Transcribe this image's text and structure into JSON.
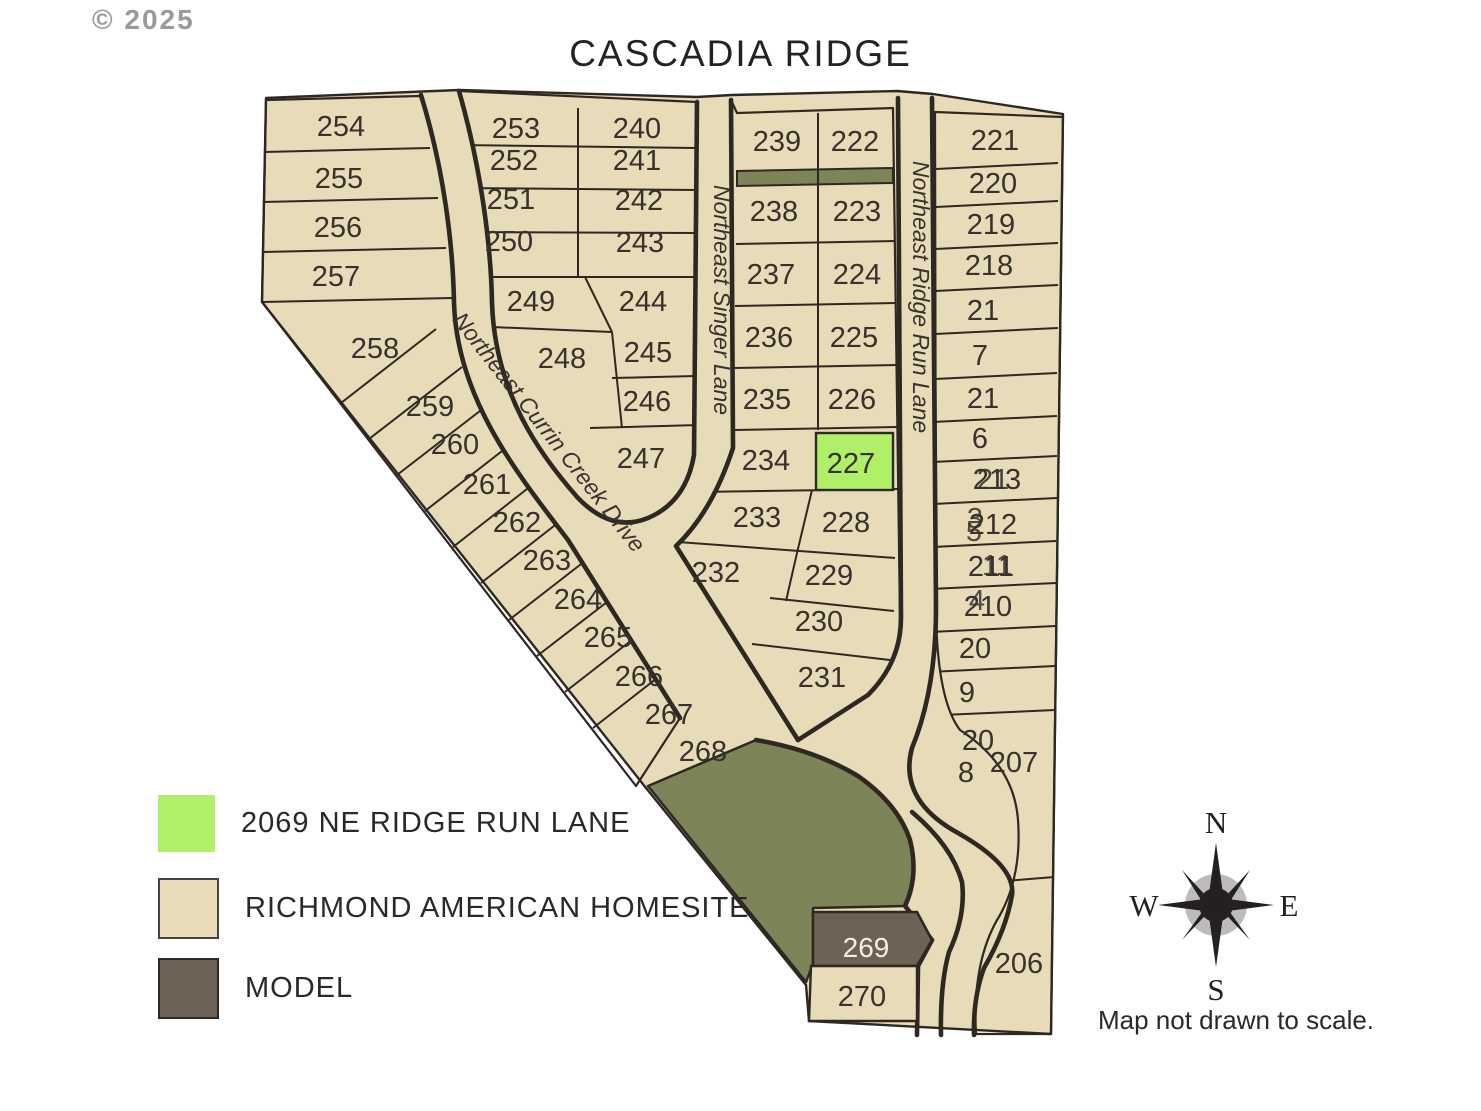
{
  "copyright": "© 2025",
  "title": "CASCADIA RIDGE",
  "footnote": "Map not drawn to scale.",
  "compass": {
    "n": "N",
    "e": "E",
    "s": "S",
    "w": "W"
  },
  "legend": {
    "items": [
      {
        "swatch": "highlight",
        "label": "2069 NE RIDGE RUN LANE"
      },
      {
        "swatch": "homesite",
        "label": "RICHMOND AMERICAN HOMESITE"
      },
      {
        "swatch": "model",
        "label": "MODEL"
      }
    ]
  },
  "colors": {
    "lot_fill": "#e8dbb8",
    "line": "#2e2823",
    "open_space": "#7d8457",
    "highlight": "#b0ef68",
    "model": "#6e6156",
    "label": "#38322e",
    "label_light": "#f4efe2"
  },
  "map": {
    "highlighted_lot": "227",
    "model_lot": "269",
    "labels": [
      {
        "t": "254",
        "x": 341,
        "y": 136
      },
      {
        "t": "255",
        "x": 339,
        "y": 188
      },
      {
        "t": "256",
        "x": 338,
        "y": 237
      },
      {
        "t": "257",
        "x": 336,
        "y": 286
      },
      {
        "t": "258",
        "x": 375,
        "y": 358
      },
      {
        "t": "259",
        "x": 430,
        "y": 416
      },
      {
        "t": "260",
        "x": 455,
        "y": 454
      },
      {
        "t": "261",
        "x": 487,
        "y": 494
      },
      {
        "t": "262",
        "x": 517,
        "y": 532
      },
      {
        "t": "263",
        "x": 547,
        "y": 570
      },
      {
        "t": "264",
        "x": 578,
        "y": 609
      },
      {
        "t": "265",
        "x": 608,
        "y": 647
      },
      {
        "t": "266",
        "x": 639,
        "y": 686
      },
      {
        "t": "267",
        "x": 669,
        "y": 724
      },
      {
        "t": "268",
        "x": 703,
        "y": 761
      },
      {
        "t": "253",
        "x": 516,
        "y": 138
      },
      {
        "t": "240",
        "x": 637,
        "y": 138
      },
      {
        "t": "252",
        "x": 514,
        "y": 170
      },
      {
        "t": "241",
        "x": 637,
        "y": 170
      },
      {
        "t": "251",
        "x": 511,
        "y": 209
      },
      {
        "t": "242",
        "x": 639,
        "y": 210
      },
      {
        "t": "250",
        "x": 509,
        "y": 251
      },
      {
        "t": "243",
        "x": 640,
        "y": 252
      },
      {
        "t": "249",
        "x": 531,
        "y": 311
      },
      {
        "t": "244",
        "x": 643,
        "y": 311
      },
      {
        "t": "248",
        "x": 562,
        "y": 368
      },
      {
        "t": "245",
        "x": 648,
        "y": 362
      },
      {
        "t": "246",
        "x": 647,
        "y": 411
      },
      {
        "t": "247",
        "x": 641,
        "y": 468
      },
      {
        "t": "239",
        "x": 777,
        "y": 151
      },
      {
        "t": "222",
        "x": 855,
        "y": 151
      },
      {
        "t": "238",
        "x": 774,
        "y": 221
      },
      {
        "t": "223",
        "x": 857,
        "y": 221
      },
      {
        "t": "237",
        "x": 771,
        "y": 284
      },
      {
        "t": "224",
        "x": 857,
        "y": 284
      },
      {
        "t": "236",
        "x": 769,
        "y": 347
      },
      {
        "t": "225",
        "x": 854,
        "y": 347
      },
      {
        "t": "235",
        "x": 767,
        "y": 409
      },
      {
        "t": "226",
        "x": 852,
        "y": 409
      },
      {
        "t": "234",
        "x": 766,
        "y": 470
      },
      {
        "t": "227",
        "x": 851,
        "y": 473
      },
      {
        "t": "233",
        "x": 757,
        "y": 527
      },
      {
        "t": "228",
        "x": 846,
        "y": 532
      },
      {
        "t": "232",
        "x": 716,
        "y": 582
      },
      {
        "t": "229",
        "x": 829,
        "y": 585
      },
      {
        "t": "230",
        "x": 819,
        "y": 631
      },
      {
        "t": "231",
        "x": 822,
        "y": 687
      },
      {
        "t": "221",
        "x": 995,
        "y": 150
      },
      {
        "t": "220",
        "x": 993,
        "y": 193
      },
      {
        "t": "219",
        "x": 991,
        "y": 234
      },
      {
        "t": "218",
        "x": 989,
        "y": 275
      },
      {
        "t": "21",
        "x": 983,
        "y": 320
      },
      {
        "t": "7",
        "x": 980,
        "y": 365
      },
      {
        "t": "21",
        "x": 983,
        "y": 408
      },
      {
        "t": "6",
        "x": 980,
        "y": 448
      },
      {
        "t": "213",
        "x": 997,
        "y": 489
      },
      {
        "t": "21",
        "x": 993,
        "y": 489,
        "o": 0.9
      },
      {
        "t": "212",
        "x": 993,
        "y": 534
      },
      {
        "t": "3",
        "x": 975,
        "y": 528,
        "o": 0.85
      },
      {
        "t": "5",
        "x": 974,
        "y": 541,
        "o": 0.85
      },
      {
        "t": "211",
        "x": 991,
        "y": 576
      },
      {
        "t": "11",
        "x": 997,
        "y": 575,
        "o": 0.85
      },
      {
        "t": "210",
        "x": 988,
        "y": 616
      },
      {
        "t": "4",
        "x": 977,
        "y": 610,
        "o": 0.85
      },
      {
        "t": "20",
        "x": 975,
        "y": 658
      },
      {
        "t": "9",
        "x": 967,
        "y": 702
      },
      {
        "t": "20",
        "x": 978,
        "y": 750
      },
      {
        "t": "8",
        "x": 966,
        "y": 782
      },
      {
        "t": "207",
        "x": 1014,
        "y": 772
      },
      {
        "t": "206",
        "x": 1019,
        "y": 973
      },
      {
        "t": "269",
        "x": 866,
        "y": 957,
        "c": "#f4efe2",
        "s": 28,
        "n": "lot-label-269-model"
      },
      {
        "t": "270",
        "x": 862,
        "y": 1006
      },
      {
        "t": "Northeast Currin Creek Drive",
        "x": 543,
        "y": 437,
        "r": 52,
        "i": 1,
        "s": 23,
        "n": "street-label-currin-creek-drive"
      },
      {
        "t": "Northeast Singer Lane",
        "x": 714,
        "y": 300,
        "r": 90,
        "i": 1,
        "s": 23,
        "n": "street-label-singer-lane"
      },
      {
        "t": "Northeast Ridge Run Lane",
        "x": 913,
        "y": 297,
        "r": 90,
        "i": 1,
        "s": 23,
        "n": "street-label-ridge-run-lane"
      }
    ]
  }
}
